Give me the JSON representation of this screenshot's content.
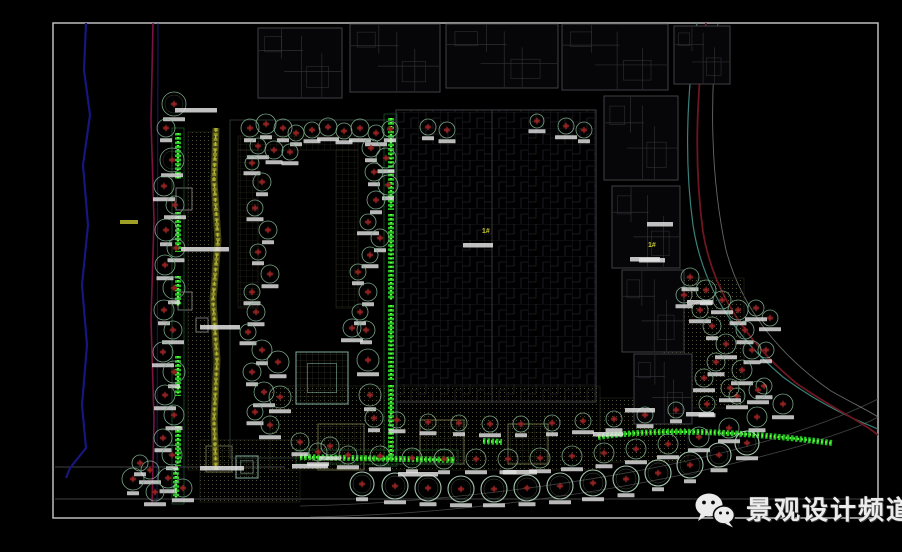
{
  "meta": {
    "width": 902,
    "height": 552,
    "description": "CAD landscape planting plan screenshot"
  },
  "watermark": {
    "text": "景观设计频道",
    "icon": "wechat-icon",
    "text_color": "#ececec"
  },
  "plan": {
    "frame": {
      "x": 53,
      "y": 23,
      "w": 825,
      "h": 495
    },
    "colors": {
      "bg": "#000000",
      "frame": "#bdbdbd",
      "river": "#16167e",
      "magenta": "#7c1240",
      "blue2": "#2a2a92",
      "teal_curve": "#3f8f86",
      "red_curve": "#6e1620",
      "gray_curve": "#8a8a8a",
      "building": "#3f3f46",
      "building_dim": "#2f2f35",
      "tree": "#7fae8e",
      "tree_bright": "#abcfb6",
      "tree_center": "#a12626",
      "tree_center_fill": "#5c1616",
      "hedge": "#21cc21",
      "hedge_hi": "#66ff44",
      "hedge_border": "#1d5228",
      "stream": "#9a9a2a",
      "stream_hi": "#b8b838",
      "label": "#e2e2e2",
      "yellow": "#c8c832",
      "paving_dot": "#6a6a40",
      "paving_edge": "#2d2d20",
      "square_edge": "#7a7a4e",
      "teal_sq": "#7fae9e",
      "refline": "#6f6f6f",
      "small_bldg": "#9a9a9a",
      "court_edge": "#3a4a42"
    },
    "ref_lines": [
      [
        55,
        467,
        285,
        467
      ],
      [
        55,
        499,
        877,
        499
      ]
    ],
    "road_arcs": [
      "M300,506 C450,503 640,478 770,440 C830,422 860,408 878,399",
      "M310,517 C480,514 660,486 800,446 C845,432 866,424 878,417"
    ],
    "left_lines": {
      "river": "M86,23 L84,70 L90,115 L83,165 L88,225 L82,285 L87,345 L82,405 L86,448 L70,468 L66,478",
      "magenta": "M153,23 L151,120 L154,220 L151,320 L154,420 L152,505",
      "blue2": "M158,23 L157,505"
    },
    "boundary_curves": [
      {
        "name": "teal",
        "d": "M697,23 C687,90 684,160 693,225 C702,285 733,335 783,377 C822,406 856,420 878,429"
      },
      {
        "name": "red",
        "d": "M706,23 C696,95 694,165 703,232 C713,292 747,342 796,383 C833,409 861,421 878,435"
      },
      {
        "name": "gray",
        "d": "M718,23 C709,100 711,180 726,250 C742,310 781,356 831,391 C856,405 871,412 878,417"
      }
    ],
    "paving_areas": [
      {
        "x": 188,
        "y": 132,
        "w": 24,
        "h": 338
      },
      {
        "x": 270,
        "y": 386,
        "w": 330,
        "h": 84
      },
      {
        "x": 200,
        "y": 440,
        "w": 100,
        "h": 62
      },
      {
        "x": 664,
        "y": 278,
        "w": 80,
        "h": 130
      },
      {
        "x": 600,
        "y": 398,
        "w": 88,
        "h": 64
      }
    ],
    "paving_squares": [
      [
        318,
        424,
        46
      ],
      [
        420,
        420,
        44
      ],
      [
        508,
        424,
        40
      ],
      [
        206,
        446,
        26
      ]
    ],
    "plaza_squares": [
      [
        296,
        352,
        52
      ],
      [
        236,
        456,
        22
      ]
    ],
    "courtyard": {
      "outline": [
        230,
        120,
        166,
        338
      ],
      "bands": [
        [
          238,
          136,
          120,
          14
        ],
        [
          238,
          150,
          20,
          158
        ],
        [
          336,
          150,
          22,
          158
        ]
      ]
    },
    "buildings": [
      [
        258,
        28,
        84,
        70
      ],
      [
        350,
        24,
        90,
        68
      ],
      [
        446,
        24,
        112,
        64
      ],
      [
        562,
        24,
        106,
        66
      ],
      [
        674,
        26,
        56,
        58
      ],
      [
        604,
        96,
        74,
        84
      ],
      [
        612,
        186,
        68,
        82
      ],
      [
        622,
        270,
        62,
        82
      ],
      [
        634,
        354,
        58,
        70
      ]
    ],
    "big_building": [
      396,
      110,
      200,
      292
    ],
    "small_structures": [
      [
        176,
        188,
        16,
        22
      ],
      [
        178,
        292,
        14,
        18
      ],
      [
        196,
        318,
        12,
        14
      ]
    ],
    "stream": {
      "d": "M216,128 L214,180 L218,240 L213,300 L217,360 L214,420 L216,470"
    },
    "hedge_borders": [
      [
        384,
        114,
        13,
        352
      ],
      [
        172,
        128,
        12,
        376
      ],
      [
        296,
        450,
        162,
        14
      ]
    ],
    "v_hedges": [
      [
        178,
        133,
        46
      ],
      [
        178,
        212,
        40
      ],
      [
        178,
        276,
        30
      ],
      [
        178,
        356,
        40
      ],
      [
        178,
        426,
        40
      ],
      [
        176,
        468,
        30
      ],
      [
        391,
        118,
        92
      ],
      [
        391,
        214,
        86
      ],
      [
        391,
        305,
        75
      ],
      [
        391,
        385,
        75
      ]
    ],
    "h_hedges": [
      "M300,457 L455,460",
      "M598,437 C660,428 740,431 832,443",
      "M483,441 L502,442"
    ],
    "trees_small": [
      [
        174,
        104,
        12
      ],
      [
        166,
        128,
        9
      ],
      [
        172,
        160,
        12
      ],
      [
        164,
        186,
        10
      ],
      [
        175,
        205,
        9
      ],
      [
        166,
        230,
        11
      ],
      [
        176,
        248,
        9
      ],
      [
        165,
        265,
        10
      ],
      [
        174,
        288,
        11
      ],
      [
        164,
        310,
        10
      ],
      [
        173,
        330,
        9
      ],
      [
        163,
        352,
        10
      ],
      [
        174,
        372,
        11
      ],
      [
        165,
        395,
        10
      ],
      [
        174,
        415,
        10
      ],
      [
        163,
        438,
        9
      ],
      [
        172,
        455,
        10
      ],
      [
        150,
        470,
        9
      ],
      [
        168,
        478,
        10
      ],
      [
        183,
        488,
        9
      ],
      [
        133,
        479,
        11
      ],
      [
        155,
        492,
        9
      ],
      [
        140,
        463,
        8
      ],
      [
        250,
        128,
        9
      ],
      [
        266,
        124,
        10
      ],
      [
        283,
        128,
        9
      ],
      [
        296,
        133,
        8
      ],
      [
        258,
        146,
        8
      ],
      [
        274,
        150,
        9
      ],
      [
        290,
        152,
        8
      ],
      [
        252,
        163,
        7
      ],
      [
        312,
        130,
        8
      ],
      [
        328,
        127,
        9
      ],
      [
        344,
        131,
        8
      ],
      [
        360,
        128,
        9
      ],
      [
        376,
        133,
        8
      ],
      [
        390,
        129,
        8
      ],
      [
        428,
        127,
        8
      ],
      [
        447,
        130,
        8
      ],
      [
        537,
        121,
        7
      ],
      [
        566,
        126,
        8
      ],
      [
        584,
        130,
        8
      ],
      [
        371,
        148,
        9
      ],
      [
        386,
        158,
        10
      ],
      [
        374,
        172,
        9
      ],
      [
        388,
        185,
        10
      ],
      [
        376,
        200,
        9
      ],
      [
        368,
        222,
        8
      ],
      [
        380,
        238,
        9
      ],
      [
        370,
        255,
        8
      ],
      [
        358,
        272,
        8
      ],
      [
        368,
        292,
        9
      ],
      [
        360,
        312,
        8
      ],
      [
        352,
        328,
        9
      ],
      [
        366,
        330,
        9
      ],
      [
        368,
        360,
        11
      ],
      [
        370,
        395,
        11
      ],
      [
        374,
        418,
        9
      ],
      [
        262,
        182,
        9
      ],
      [
        255,
        208,
        8
      ],
      [
        268,
        230,
        9
      ],
      [
        258,
        252,
        8
      ],
      [
        270,
        274,
        9
      ],
      [
        252,
        292,
        8
      ],
      [
        256,
        312,
        9
      ],
      [
        248,
        332,
        8
      ],
      [
        262,
        350,
        10
      ],
      [
        252,
        372,
        9
      ],
      [
        264,
        392,
        10
      ],
      [
        255,
        412,
        8
      ],
      [
        270,
        425,
        9
      ],
      [
        278,
        362,
        11
      ],
      [
        280,
        397,
        11
      ],
      [
        300,
        442,
        9
      ],
      [
        330,
        446,
        9
      ],
      [
        397,
        420,
        8
      ],
      [
        428,
        422,
        8
      ],
      [
        459,
        423,
        8
      ],
      [
        490,
        424,
        8
      ],
      [
        521,
        424,
        8
      ],
      [
        552,
        423,
        8
      ],
      [
        583,
        421,
        8
      ],
      [
        614,
        419,
        8
      ],
      [
        645,
        415,
        8
      ],
      [
        676,
        410,
        8
      ],
      [
        707,
        404,
        8
      ],
      [
        737,
        396,
        8
      ],
      [
        764,
        386,
        8
      ],
      [
        318,
        452,
        9
      ],
      [
        348,
        455,
        9
      ],
      [
        380,
        456,
        10
      ],
      [
        412,
        458,
        10
      ],
      [
        444,
        459,
        10
      ],
      [
        476,
        459,
        10
      ],
      [
        508,
        459,
        10
      ],
      [
        540,
        458,
        10
      ],
      [
        572,
        456,
        10
      ],
      [
        604,
        453,
        10
      ],
      [
        636,
        449,
        10
      ],
      [
        668,
        444,
        10
      ],
      [
        699,
        437,
        10
      ],
      [
        729,
        428,
        10
      ],
      [
        757,
        417,
        10
      ],
      [
        783,
        404,
        10
      ],
      [
        690,
        277,
        9
      ],
      [
        706,
        290,
        10
      ],
      [
        722,
        300,
        9
      ],
      [
        700,
        310,
        8
      ],
      [
        738,
        310,
        10
      ],
      [
        712,
        326,
        9
      ],
      [
        745,
        330,
        9
      ],
      [
        726,
        344,
        10
      ],
      [
        752,
        350,
        9
      ],
      [
        716,
        362,
        9
      ],
      [
        742,
        370,
        10
      ],
      [
        704,
        378,
        9
      ],
      [
        730,
        388,
        9
      ],
      [
        758,
        390,
        9
      ],
      [
        766,
        350,
        8
      ],
      [
        770,
        318,
        8
      ],
      [
        684,
        295,
        8
      ],
      [
        756,
        308,
        8
      ]
    ],
    "trees_big": [
      [
        362,
        484,
        12
      ],
      [
        395,
        486,
        13
      ],
      [
        428,
        488,
        13
      ],
      [
        461,
        489,
        13
      ],
      [
        494,
        489,
        13
      ],
      [
        527,
        488,
        13
      ],
      [
        560,
        486,
        13
      ],
      [
        593,
        483,
        13
      ],
      [
        626,
        479,
        13
      ],
      [
        658,
        473,
        13
      ],
      [
        690,
        465,
        13
      ],
      [
        719,
        455,
        12
      ],
      [
        747,
        443,
        12
      ]
    ],
    "annotations": [
      [
        196,
        108,
        42
      ],
      [
        205,
        247,
        48
      ],
      [
        220,
        325,
        40
      ],
      [
        222,
        466,
        44
      ],
      [
        310,
        464,
        36
      ],
      [
        418,
        472,
        40
      ],
      [
        520,
        470,
        34
      ],
      [
        640,
        408,
        30
      ],
      [
        700,
        412,
        28
      ],
      [
        660,
        222,
        26
      ],
      [
        652,
        258,
        26
      ],
      [
        700,
        300,
        26
      ],
      [
        608,
        432,
        30
      ],
      [
        478,
        243,
        30
      ],
      [
        645,
        257,
        30
      ]
    ],
    "building_numbers": [
      {
        "x": 482,
        "y": 233,
        "label": "1#"
      },
      {
        "x": 648,
        "y": 247,
        "label": "1#"
      }
    ],
    "river_label": [
      120,
      220,
      18
    ]
  }
}
